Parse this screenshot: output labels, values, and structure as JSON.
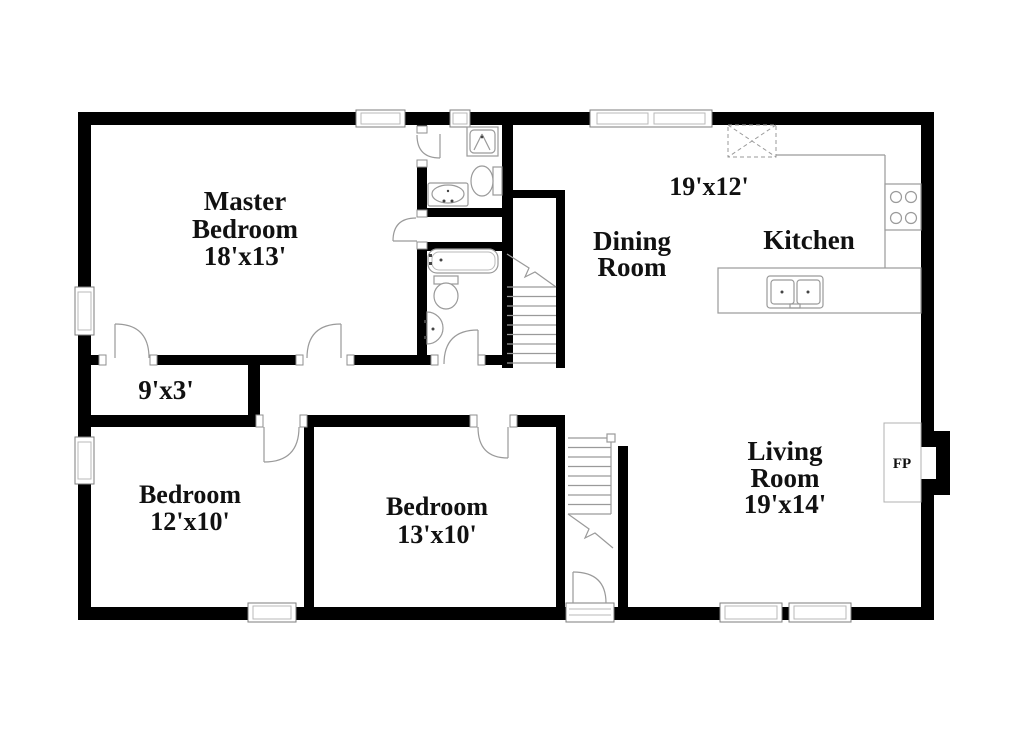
{
  "canvas": {
    "background": "#ffffff",
    "wall_color": "#000000",
    "fixture_line_color": "#9a9a9a",
    "text_color": "#111111"
  },
  "rooms": {
    "master_bedroom": {
      "name_lines": [
        "Master",
        "Bedroom"
      ],
      "dims": "18'x13'"
    },
    "dining_room": {
      "name_lines": [
        "Dining",
        "Room"
      ]
    },
    "kitchen_dining_area": {
      "dims": "19'x12'"
    },
    "kitchen": {
      "name": "Kitchen"
    },
    "living_room": {
      "name_lines": [
        "Living",
        "Room"
      ],
      "dims": "19'x14'"
    },
    "bedroom_2": {
      "name": "Bedroom",
      "dims": "12'x10'"
    },
    "bedroom_3": {
      "name": "Bedroom",
      "dims": "13'x10'"
    },
    "closet": {
      "dims": "9'x3'"
    },
    "fireplace": {
      "label": "FP"
    }
  },
  "fixtures": [
    "shower",
    "toilet",
    "vanity-sink",
    "bathtub",
    "pedestal-sink",
    "basement-stairs",
    "entry-stairs",
    "kitchen-double-sink",
    "stove-cooktop",
    "refrigerator-dashed-box",
    "fireplace",
    "window",
    "door-swing"
  ]
}
